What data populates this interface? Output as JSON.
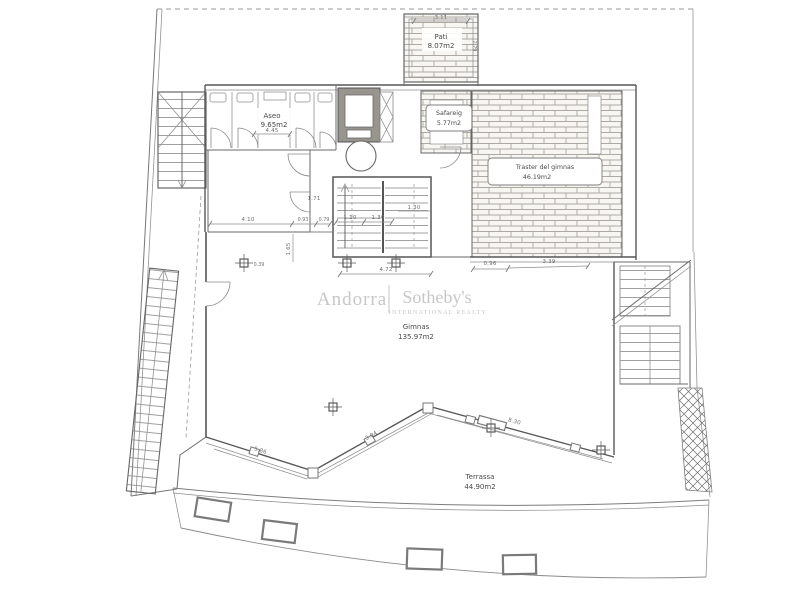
{
  "page": {
    "type": "architectural floor plan scan",
    "background": "#ffffff"
  },
  "colors": {
    "wall": "#575757",
    "thin_line": "#8d8d8d",
    "brick_hatch": "#ada9a3",
    "label_text": "#4a4a4a",
    "dimension_text": "#6e6e6e",
    "watermark": "#c7c7c7"
  },
  "watermark": {
    "brand_left": "Andorra",
    "brand_right": "Sotheby's",
    "brand_sub": "INTERNATIONAL REALTY"
  },
  "rooms": {
    "pati": {
      "name": "Pati",
      "area": "8.07m2"
    },
    "aseo": {
      "name": "Aseo",
      "area": "9.65m2"
    },
    "safareig": {
      "name": "Safareig",
      "area": "5.77m2"
    },
    "traster": {
      "name": "Traster del gimnas",
      "area": "46.19m2"
    },
    "gimnas": {
      "name": "Gimnas",
      "area": "135.97m2"
    },
    "terrassa": {
      "name": "Terrassa",
      "area": "44.90m2"
    }
  },
  "dims": {
    "pati_w": "3.11",
    "pati_h": "2.79",
    "aseo_w": "4.45",
    "door_171": "1.71",
    "hall_410": "4.10",
    "seg_093": "0.93",
    "seg_079": "0.79",
    "col_039": "0.39",
    "stair_110": "1.10",
    "stair_130a": "1.30",
    "stair_130b": "1.30",
    "left_165": "1.65",
    "stair_w_472": "4.72",
    "traster_096": "0.96",
    "traster_339": "3.39",
    "terrace_a": "5.86",
    "terrace_b": "3.04",
    "terrace_c": "8.30"
  }
}
